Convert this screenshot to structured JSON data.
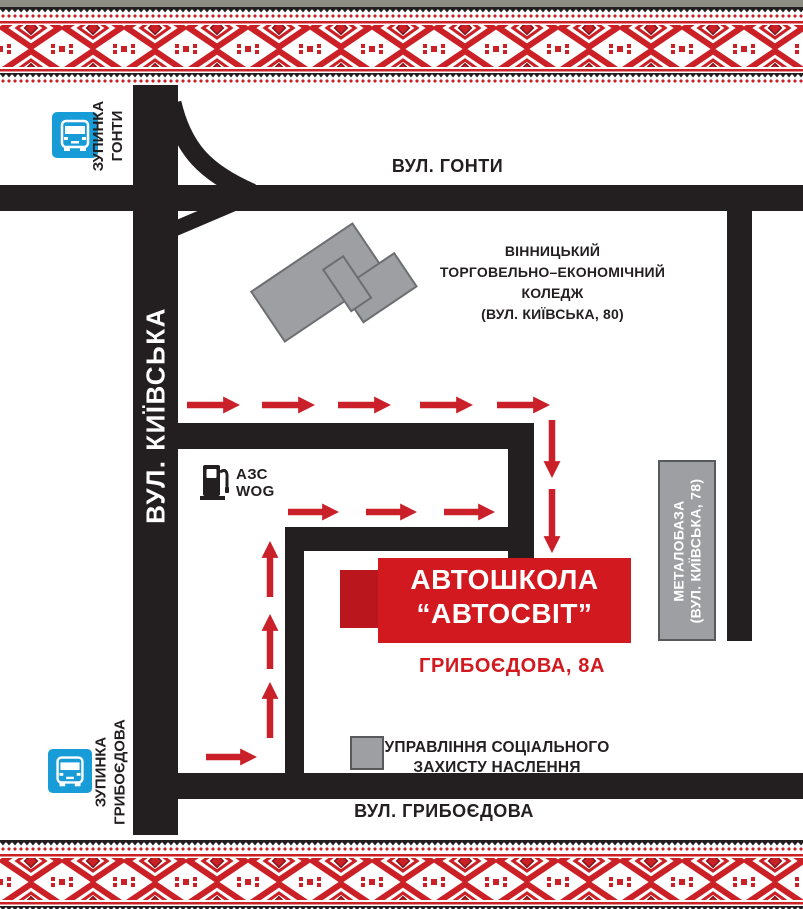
{
  "colors": {
    "road": "#231f20",
    "route_arrow_red": "#c9202a",
    "school_red": "#d2191f",
    "school_red_dark": "#b9161d",
    "building_gray": "#9d9fa2",
    "building_border": "#58595b",
    "bus_stop_blue": "#189cd8",
    "embroidery_red": "#cb2026",
    "embroidery_black": "#231f20"
  },
  "streets": {
    "honty": "ВУЛ. ГОНТИ",
    "kyivska": "ВУЛ. КИЇВСЬКА",
    "hryboiedova": "ВУЛ. ГРИБОЄДОВА"
  },
  "bus_stops": [
    {
      "lines": [
        "ЗУПИНКА",
        "ГОНТИ"
      ]
    },
    {
      "lines": [
        "ЗУПИНКА",
        "ГРИБОЄДОВА"
      ]
    }
  ],
  "college": {
    "lines": [
      "ВІННИЦЬКИЙ",
      "ТОРГОВЕЛЬНО–ЕКОНОМІЧНИЙ",
      "КОЛЕДЖ",
      "(ВУЛ. КИЇВСЬКА, 80)"
    ]
  },
  "gas_station": {
    "lines": [
      "АЗС",
      "WOG"
    ]
  },
  "driving_school": {
    "name_lines": [
      "АВТОШКОЛА",
      "“АВТОСВІТ”"
    ],
    "address": "ГРИБОЄДОВА, 8А"
  },
  "metal_base": {
    "lines": [
      "МЕТАЛОБАЗА",
      "(ВУЛ. КИЇВСЬКА, 78)"
    ]
  },
  "social_office": {
    "lines": [
      "УПРАВЛІННЯ СОЦІАЛЬНОГО",
      "ЗАХИСТУ НАСЛЕННЯ"
    ]
  }
}
